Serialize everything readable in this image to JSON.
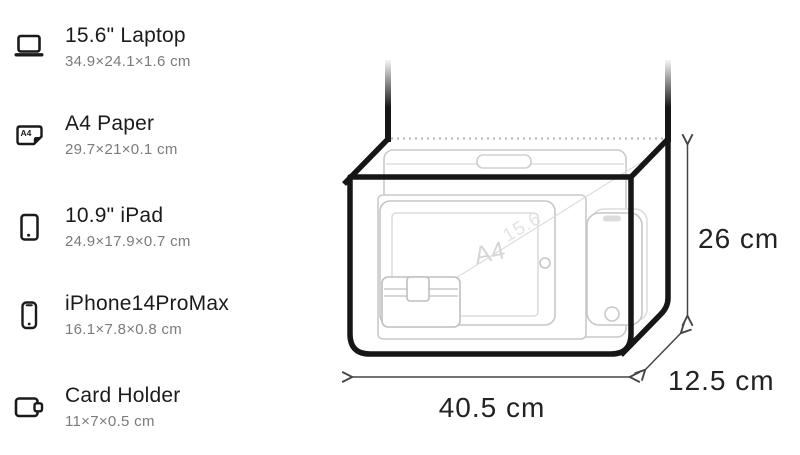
{
  "items": [
    {
      "name": "15.6\" Laptop",
      "dims": "34.9×24.1×1.6 cm",
      "icon": "laptop-icon"
    },
    {
      "name": "A4 Paper",
      "dims": "29.7×21×0.1 cm",
      "icon": "a4-paper-icon",
      "icon_label": "A4"
    },
    {
      "name": "10.9\" iPad",
      "dims": "24.9×17.9×0.7 cm",
      "icon": "ipad-icon"
    },
    {
      "name": "iPhone14ProMax",
      "dims": "16.1×7.8×0.8 cm",
      "icon": "iphone-icon"
    },
    {
      "name": "Card Holder",
      "dims": "11×7×0.5 cm",
      "icon": "card-holder-icon"
    }
  ],
  "diagram": {
    "width_label": "40.5 cm",
    "height_label": "26 cm",
    "depth_label": "12.5 cm",
    "laptop_watermark": "15.6",
    "paper_watermark": "A4"
  },
  "colors": {
    "outline": "#161616",
    "faint_item_stroke": "#c9c9c9",
    "dotted_opening": "#b5b5b5",
    "dimension_line": "#454545",
    "dimension_text": "#222222",
    "title_text": "#1b1b1b",
    "secondary_text": "#7b7b7b"
  }
}
